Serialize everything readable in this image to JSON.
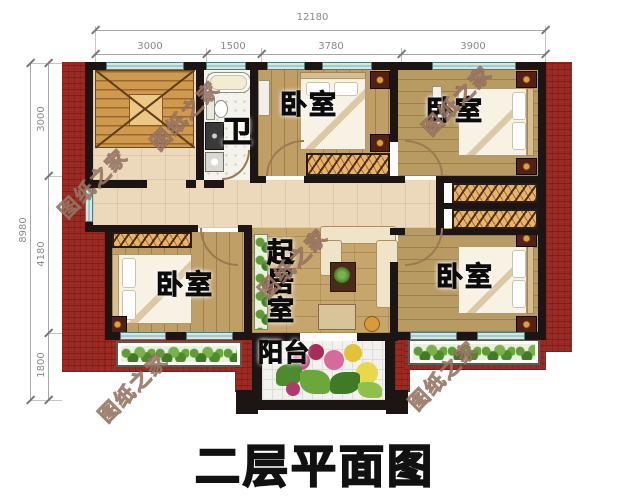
{
  "title": "二层平面图",
  "watermark": "图纸之家",
  "dimensions": {
    "top": {
      "overall": "12180",
      "segments": [
        "3000",
        "1500",
        "3780",
        "3900"
      ]
    },
    "left": {
      "overall": "8980",
      "segments": [
        "3000",
        "4180",
        "1800"
      ]
    }
  },
  "rooms": {
    "bathroom": "卫",
    "bedroom_top_middle": "卧室",
    "bedroom_top_right": "卧室",
    "bedroom_bottom_left": "卧室",
    "bedroom_bottom_right": "卧室",
    "living_room": "起居室",
    "balcony": "阳台"
  },
  "colors": {
    "roof_red": "#9a2a23",
    "wall_black": "#1d1514",
    "window_teal": "#cfe9e6",
    "wood_floor": "#bf9f66",
    "hall_floor": "#ecd9bc",
    "hatch_wardrobe": "#eab468"
  }
}
